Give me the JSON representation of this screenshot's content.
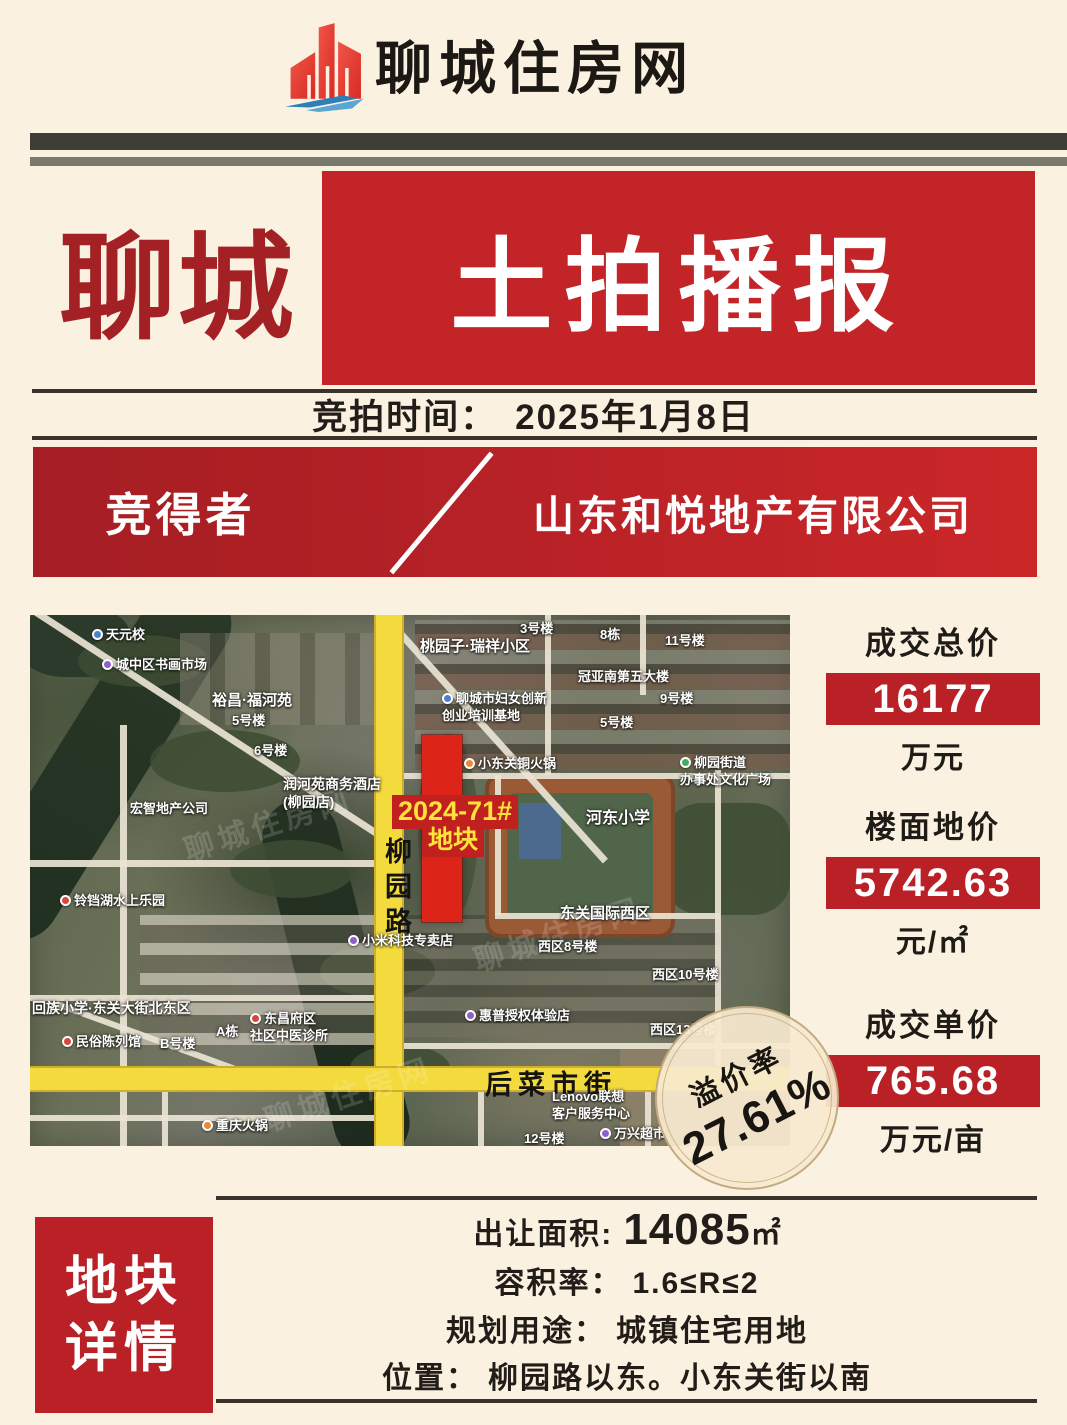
{
  "header": {
    "site_name": "聊城住房网",
    "logo_icon": "building-wave-logo",
    "logo_colors": {
      "red": "#e8392f",
      "blue": "#2e7fb5"
    }
  },
  "title": {
    "city": "聊城",
    "banner": "土拍播报"
  },
  "auction": {
    "label": "竞拍时间：",
    "value": "2025年1月8日"
  },
  "winner": {
    "label": "竞得者",
    "value": "山东和悦地产有限公司"
  },
  "stats": [
    {
      "label": "成交总价",
      "value": "16177",
      "unit": "万元"
    },
    {
      "label": "楼面地价",
      "value": "5742.63",
      "unit": "元/㎡"
    },
    {
      "label": "成交单价",
      "value": "765.68",
      "unit": "万元/亩"
    }
  ],
  "premium": {
    "label": "溢价率",
    "value": "27.61%"
  },
  "map": {
    "plot": {
      "line1": "2024-71#",
      "line2": "地块"
    },
    "road_vertical": "柳园路",
    "road_horizontal": "后菜市街",
    "watermark": "聊城住房网",
    "labels": [
      {
        "text": "天元校",
        "x": 62,
        "y": 12,
        "pin": "blue"
      },
      {
        "text": "城中区书画市场",
        "x": 72,
        "y": 42,
        "pin": "purple"
      },
      {
        "text": "裕昌·福河苑",
        "x": 182,
        "y": 76,
        "size": 15
      },
      {
        "text": "5号楼",
        "x": 202,
        "y": 98
      },
      {
        "text": "6号楼",
        "x": 224,
        "y": 128
      },
      {
        "text": "润河苑商务酒店",
        "text2": "(柳园店)",
        "x": 253,
        "y": 160,
        "size": 14
      },
      {
        "text": "宏智地产公司",
        "x": 100,
        "y": 186
      },
      {
        "text": "铃铛湖水上乐园",
        "x": 30,
        "y": 278,
        "pin": "red"
      },
      {
        "text": "回族小学·东关大街北东区",
        "x": 2,
        "y": 384,
        "size": 14
      },
      {
        "text": "民俗陈列馆",
        "x": 32,
        "y": 419,
        "pin": "red"
      },
      {
        "text": "B号楼",
        "x": 130,
        "y": 421
      },
      {
        "text": "A栋",
        "x": 186,
        "y": 409
      },
      {
        "text": "东昌府区",
        "text2": "社区中医诊所",
        "x": 220,
        "y": 396,
        "pin": "red"
      },
      {
        "text": "小米科技专卖店",
        "x": 318,
        "y": 318,
        "pin": "purple"
      },
      {
        "text": "重庆火锅",
        "x": 172,
        "y": 503,
        "pin": "orange"
      },
      {
        "text": "桃园子·瑞祥小区",
        "x": 390,
        "y": 22,
        "size": 15
      },
      {
        "text": "3号楼",
        "x": 490,
        "y": 6
      },
      {
        "text": "8栋",
        "x": 570,
        "y": 12
      },
      {
        "text": "11号楼",
        "x": 635,
        "y": 18
      },
      {
        "text": "冠亚南第五大楼",
        "x": 548,
        "y": 54
      },
      {
        "text": "9号楼",
        "x": 630,
        "y": 76
      },
      {
        "text": "5号楼",
        "x": 570,
        "y": 100
      },
      {
        "text": "聊城市妇女创新",
        "text2": "创业培训基地",
        "x": 412,
        "y": 76,
        "pin": "blue"
      },
      {
        "text": "小东关铜火锅",
        "x": 434,
        "y": 141,
        "pin": "orange"
      },
      {
        "text": "柳园街道",
        "text2": "办事处文化广场",
        "x": 650,
        "y": 140,
        "pin": "green"
      },
      {
        "text": "河东小学",
        "x": 556,
        "y": 194,
        "size": 16
      },
      {
        "text": "东关国际西区",
        "x": 530,
        "y": 289,
        "size": 15
      },
      {
        "text": "西区8号楼",
        "x": 508,
        "y": 324
      },
      {
        "text": "西区10号楼",
        "x": 622,
        "y": 352
      },
      {
        "text": "惠普授权体验店",
        "x": 435,
        "y": 393,
        "pin": "purple"
      },
      {
        "text": "西区13号楼",
        "x": 620,
        "y": 407
      },
      {
        "text": "Lenovo联想",
        "text2": "客户服务中心",
        "x": 522,
        "y": 474
      },
      {
        "text": "万兴超市",
        "x": 570,
        "y": 511,
        "pin": "purple"
      },
      {
        "text": "12号楼",
        "x": 494,
        "y": 516
      }
    ]
  },
  "details": {
    "panel": {
      "line1": "地块",
      "line2": "详情"
    },
    "rows": [
      {
        "label": "出让面积:",
        "value": "14085",
        "unit": "㎡"
      },
      {
        "label": "容积率：",
        "value": "1.6≤R≤2"
      },
      {
        "label": "规划用途：",
        "value": "城镇住宅用地"
      },
      {
        "label": "位置：",
        "value": "柳园路以东。小东关街以南"
      }
    ]
  },
  "colors": {
    "background_cream": "#fbf1e0",
    "title_red": "#c22428",
    "city_text_red": "#a32125",
    "stat_box_red": "#ba2127",
    "plot_red": "#dd2418",
    "plot_label_yellow": "#ffe23a",
    "road_yellow": "#f3da3d",
    "bar_dark": "#3e3d38",
    "bar_olive": "#7a796d"
  }
}
